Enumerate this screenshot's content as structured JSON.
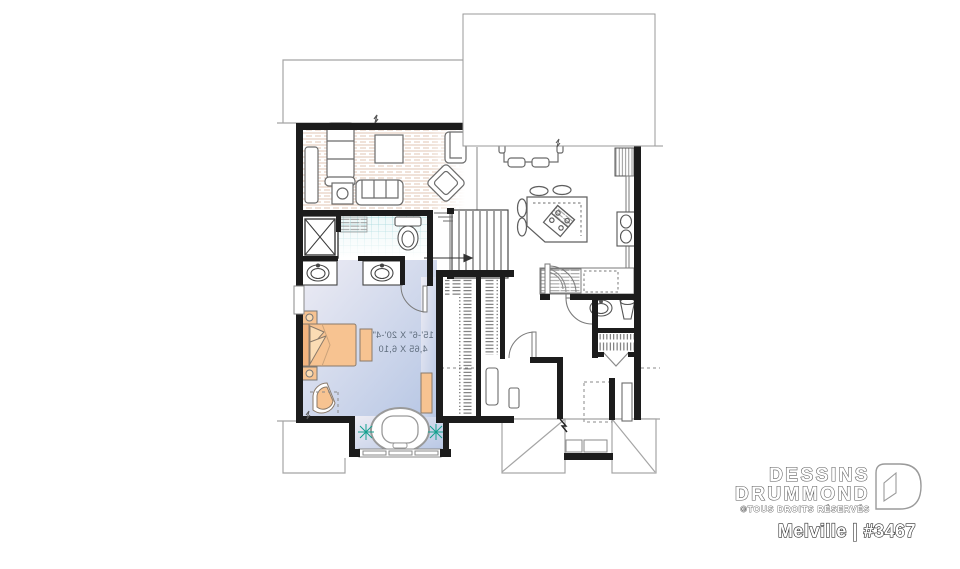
{
  "branding": {
    "brand_line1": "DESSINS",
    "brand_line2": "DRUMMOND",
    "rights": "©TOUS DROITS RÉSERVÉS",
    "plan_label": "Melville | #3467"
  },
  "bedroom": {
    "dim_imperial": "15'-6\" X 20'-4\"",
    "dim_metric": "4,65 X 6,10"
  },
  "colors": {
    "wall": "#1c1c1c",
    "furniture_accent": "#f7c391",
    "furniture_accent_light": "#fbdcb4",
    "bedroom_floor_light": "#edecf4",
    "bedroom_floor_dark": "#b6c6e4",
    "tile_line": "#8fd0d4",
    "tile_fill": "#e3f2f3",
    "wood_line": "#d7b49a",
    "plant": "#13a08f",
    "outline": "#6b6b6b",
    "exterior_line": "#a5a5a5"
  }
}
